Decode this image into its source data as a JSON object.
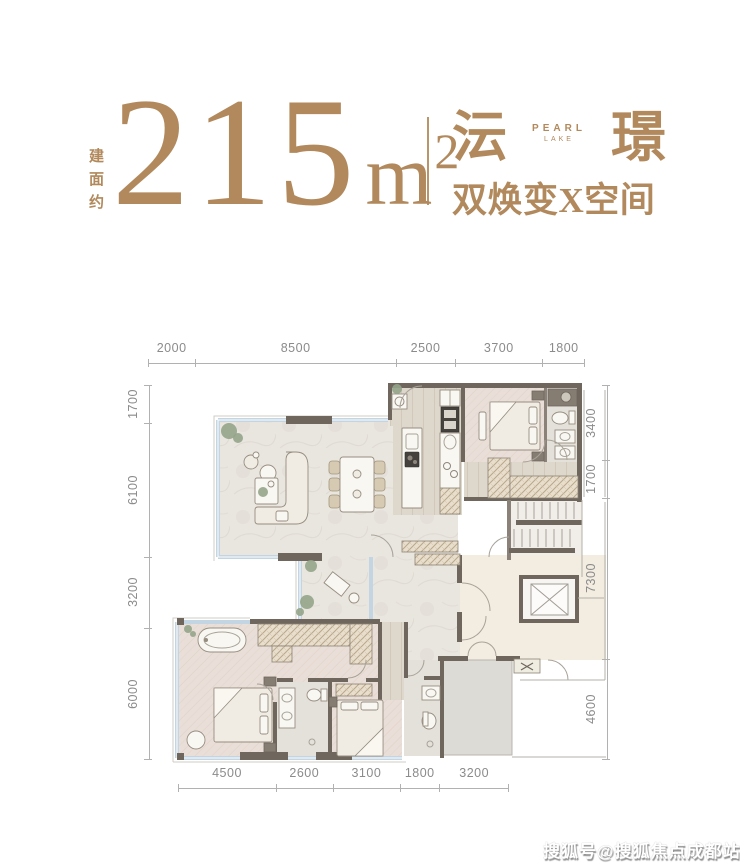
{
  "header": {
    "area_label_vertical": "建面约",
    "area_value": "215",
    "area_unit": "m",
    "area_superscript": "2",
    "brand_char_left": "沄",
    "brand_char_right": "璟",
    "brand_en_line1": "PEARL",
    "brand_en_line2": "LAKE",
    "tagline": "双焕变X空间"
  },
  "floorplan": {
    "dimensions": {
      "top": [
        "2000",
        "8500",
        "2500",
        "3700",
        "1800"
      ],
      "bottom": [
        "4500",
        "2600",
        "3100",
        "1800",
        "3200"
      ],
      "left": [
        "1700",
        "6100",
        "3200",
        "6000"
      ],
      "right": [
        "3400",
        "1700",
        "7300",
        "4600"
      ]
    },
    "elements": [
      "sofa",
      "dining-table",
      "kitchen-island",
      "refrigerator",
      "washer",
      "bed",
      "wardrobe",
      "bathtub",
      "toilet",
      "sink",
      "shower",
      "staircase",
      "elevator",
      "entrance-double-door",
      "plant"
    ]
  },
  "watermark": {
    "text": "搜狐号@搜狐焦点成都站"
  },
  "colors": {
    "accent": "#b1895c",
    "dim": "#8b8b8b",
    "wall": "#6f675d",
    "wall-light": "#8a8178",
    "window": "#c3d4e2",
    "floor-marble": "#e9e5df",
    "floor-wood": "#ded7cb",
    "floor-herring": "#eadfd8",
    "floor-tile": "#e4e1da",
    "floor-cream": "#f2ece1",
    "floor-grey": "#dcdbd5",
    "furniture": "#f1ece3",
    "furniture-stroke": "#968d81",
    "plant": "#93a489",
    "thin": "#b4b0a9"
  }
}
